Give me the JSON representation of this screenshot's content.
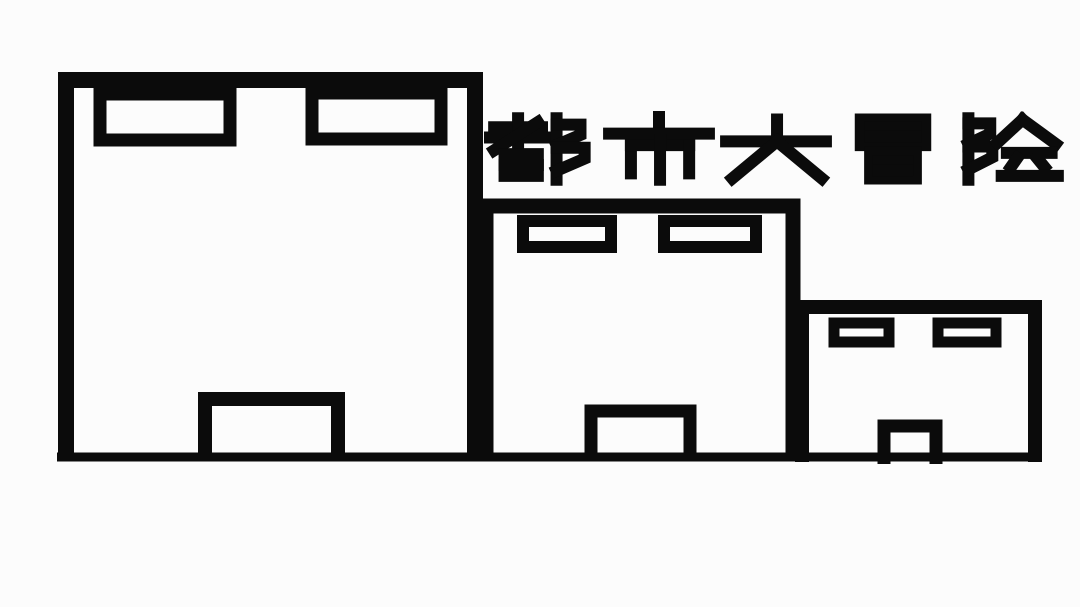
{
  "canvas": {
    "width": 1080,
    "height": 607,
    "background_color": "#fcfcfc",
    "ink_color": "#0b0b0b"
  },
  "title": {
    "text": "都市大冒险",
    "characters": [
      "都",
      "市",
      "大",
      "冒",
      "险"
    ]
  },
  "scene": {
    "description": "Three hand-drawn buildings of decreasing size standing on a ground line",
    "ground_line": true,
    "buildings": [
      {
        "size": "large",
        "position": "left",
        "windows": 2,
        "doors": 1
      },
      {
        "size": "medium",
        "position": "middle",
        "windows": 2,
        "doors": 1
      },
      {
        "size": "small",
        "position": "right",
        "windows": 2,
        "doors": 1
      }
    ]
  }
}
